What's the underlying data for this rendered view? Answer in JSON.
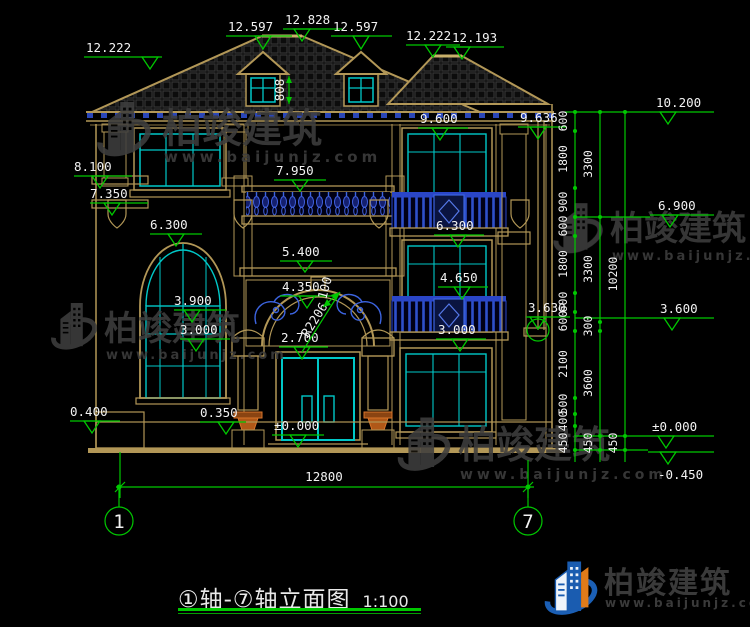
{
  "drawing": {
    "title": "①轴-⑦轴立面图",
    "scale_label": "1:100",
    "axis": [
      "1",
      "7"
    ],
    "bottom_dim": "12800",
    "dormer_height": "808",
    "arch_radius": "R2206",
    "arch_band": "100",
    "roof_levels": [
      "12.222",
      "12.597",
      "12.828",
      "12.597",
      "12.222",
      "12.193"
    ],
    "left_levels": [
      "8.100",
      "7.350",
      "6.300",
      "3.900",
      "3.000",
      "0.400",
      "0.350"
    ],
    "center_levels": [
      "7.950",
      "5.400",
      "4.350",
      "2.700",
      "±0.000"
    ],
    "right_levels": [
      "9.600",
      "9.636",
      "6.300",
      "4.650",
      "3.000",
      "3.630"
    ],
    "elev_levels": [
      "10.200",
      "6.900",
      "3.600",
      "±0.000",
      "-0.450"
    ],
    "chain_inner": [
      "600",
      "1800",
      "900",
      "600",
      "1800",
      "600",
      "600",
      "2100",
      "500",
      "400",
      "450"
    ],
    "chain_mid": [
      "3300",
      "3300",
      "300",
      "3600",
      "450"
    ],
    "chain_outer": [
      "10200",
      "450"
    ]
  },
  "watermark": {
    "name": "柏竣建筑",
    "url": "www.baijunjz.com"
  },
  "footer": {
    "brand": "柏竣建筑",
    "url": "www.baijunjz.com"
  },
  "colors": {
    "dim_green": "#00c800",
    "line_tan": "#b29757",
    "window_cyan": "#00c8c8",
    "railing_blue": "#3c64e0",
    "text_white": "#f2f2f2"
  }
}
